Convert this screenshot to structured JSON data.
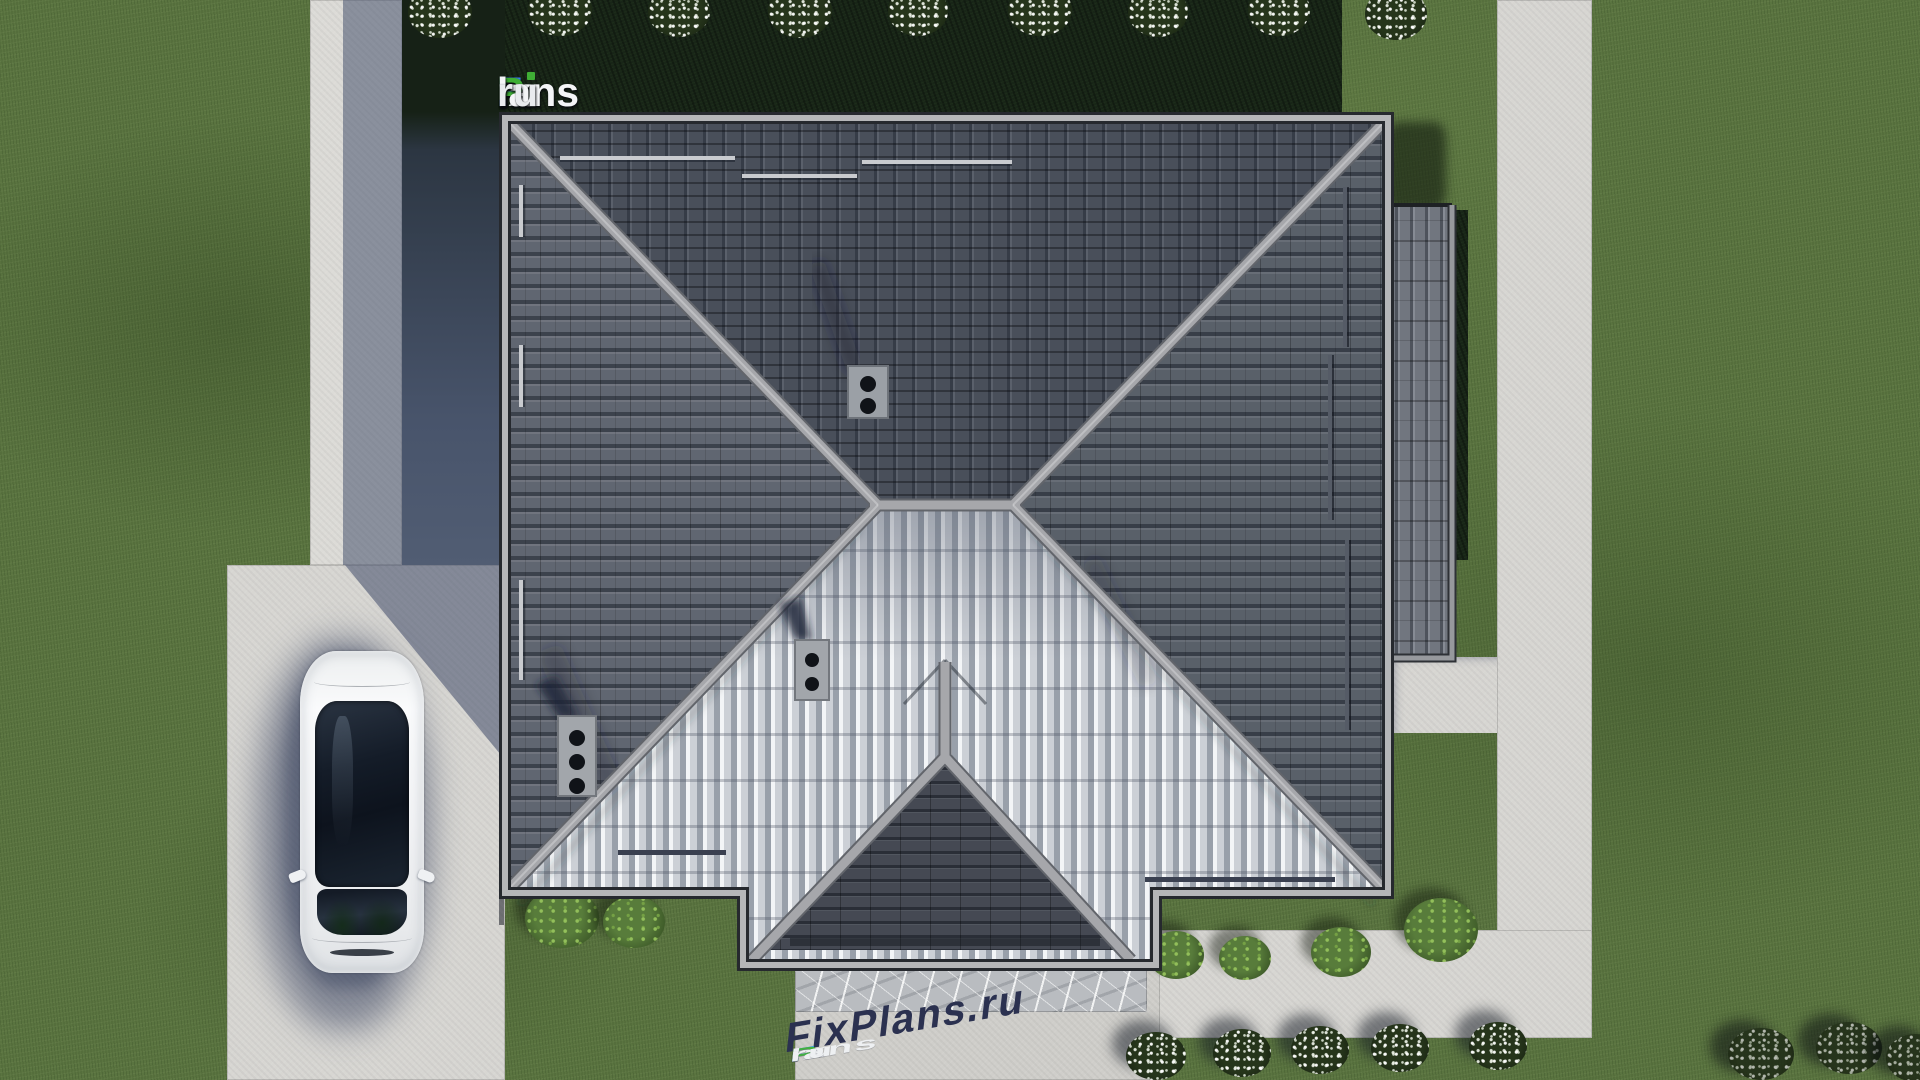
{
  "watermark_top": {
    "text": "FixPlans.ru",
    "segments": [
      {
        "text": "F",
        "color": "#3b82f0"
      },
      {
        "text": "ix",
        "color": "#f4f5f7"
      },
      {
        "text": "P",
        "color": "#3fae35"
      },
      {
        "text": "lans",
        "color": "#f4f5f7"
      },
      {
        "text": ".",
        "color": "#2f6de0"
      },
      {
        "text": "ru",
        "color": "#e9ebee"
      }
    ]
  },
  "watermark_ground": {
    "text": "FixPlans.ru",
    "shadow_color": "#2b3150",
    "segments": [
      {
        "text": "F",
        "color": "#2ba3e8"
      },
      {
        "text": "ix",
        "color": "#eef0f2"
      },
      {
        "text": "P",
        "color": "#43b13f"
      },
      {
        "text": "lans",
        "color": "#eef0f2"
      },
      {
        "text": ".",
        "color": "#2ba3e8"
      },
      {
        "text": "ru",
        "color": "#eef0f2"
      }
    ]
  },
  "palette": {
    "grass": "#5a7440",
    "hedge": "#182517",
    "concrete": "#d7d6d2",
    "marble": "#b9bcc0",
    "roof_north": "#59606c",
    "roof_side": "#656b76",
    "roof_bright": "#dadce0",
    "roof_porch": "#4d525d",
    "roof_annex": "#71767f",
    "ridge": "#a6a7ab",
    "fascia": "#b5b6b8",
    "fascia_dark": "#26292e",
    "car_body": "#f4f5f6",
    "car_glass": "#141b26",
    "shadow_blue": "#404a68",
    "wm_shadow": "#2b3150"
  }
}
